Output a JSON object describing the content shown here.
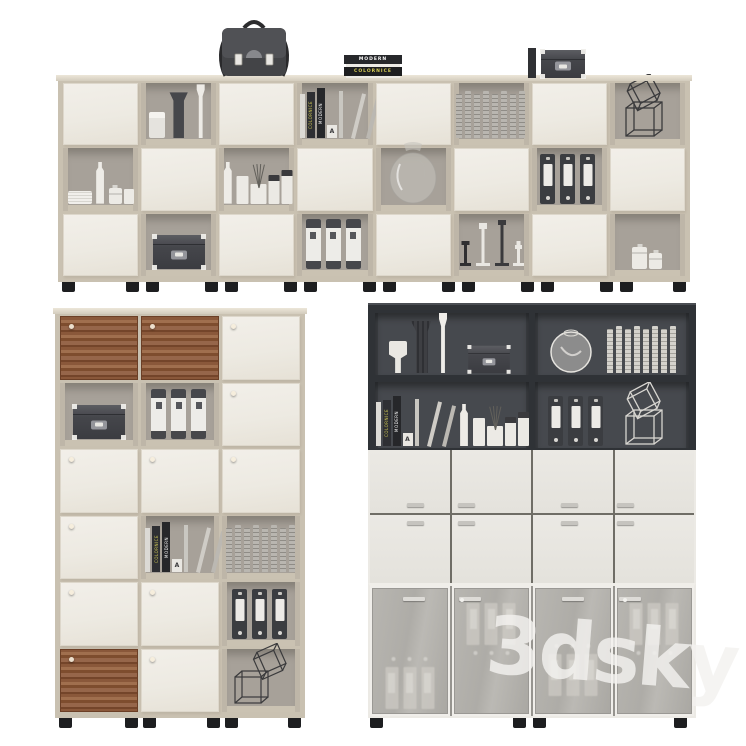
{
  "scene": {
    "description": "3D render of office storage cabinets with decor props",
    "background": "#ffffff",
    "watermark": {
      "text": "3dsky"
    },
    "book_titles": {
      "primary": "MODERN",
      "secondary": "COLORNICE",
      "bookend_letter": "A"
    }
  },
  "palette": {
    "frame_beige": "#c9c1b1",
    "door_cream": "#f0ece5",
    "cell_back": "#a7a199",
    "wood_brown": "#8a583a",
    "dark_cabinet": "#2f3236",
    "dark_back": "#46494e",
    "white_door": "#e9e7e2",
    "glass_gray": "#b2b0ab",
    "foot_black": "#1d1e20",
    "binder_dark": "#3b3d41",
    "item_white": "#eceae5"
  },
  "units": {
    "sideboard": {
      "x": 58,
      "y": 75,
      "w": 632,
      "h": 217,
      "cols": 8,
      "cells": [
        [
          "door",
          "vases3",
          "door",
          "books-lean",
          "door",
          "book-row",
          "door",
          "wire-cube"
        ],
        [
          "white-set",
          "door",
          "diffuser-set",
          "door",
          "glass-vase",
          "door",
          "binders-dark",
          "door"
        ],
        [
          "door",
          "box-dark",
          "door",
          "binders-white",
          "door",
          "candlesticks",
          "door",
          "jars-small"
        ]
      ],
      "top_items": [
        {
          "type": "briefcase",
          "x": 152
        },
        {
          "type": "book-stack",
          "x": 286
        },
        {
          "type": "box-top",
          "x": 470
        }
      ],
      "feet": [
        4,
        68,
        88,
        147,
        167,
        226,
        246,
        305,
        325,
        384,
        404,
        463,
        483,
        542,
        562,
        615
      ]
    },
    "tall_cabinet": {
      "x": 55,
      "y": 308,
      "w": 250,
      "h": 420,
      "cols": 3,
      "cells": [
        [
          "wood",
          "wood",
          "door"
        ],
        [
          "box-dark",
          "binders-white",
          "door"
        ],
        [
          "door",
          "door",
          "door"
        ],
        [
          "door",
          "books-lean",
          "book-row"
        ],
        [
          "door",
          "door",
          "binders-dark"
        ],
        [
          "wood",
          "door",
          "wire-cubes2"
        ]
      ],
      "feet": [
        4,
        70,
        88,
        152,
        170,
        233
      ]
    },
    "office_cabinet": {
      "x": 368,
      "y": 303,
      "w": 328,
      "h": 425,
      "dark_shelves": [
        [
          "vases3d",
          "box-dark-sm"
        ],
        [
          "sphere-vase",
          "book-row-light"
        ],
        [
          "books-lean-d",
          "diffuser-set"
        ],
        [
          "binders-dark",
          "wire-cube-light"
        ]
      ],
      "mid_handles_x": [
        0.58,
        0.2,
        0.47,
        0.15
      ],
      "glass_doors": [
        {
          "handle_x": 0.55,
          "dot": false,
          "ghost_top": 0.42
        },
        {
          "handle_x": 0.22,
          "dot": true,
          "ghost_top": 0.04
        },
        {
          "handle_x": 0.5,
          "dot": false,
          "ghost_top": 0.32
        },
        {
          "handle_x": 0.18,
          "dot": true,
          "ghost_top": 0.04
        }
      ],
      "feet": [
        2,
        145,
        165,
        306
      ]
    }
  }
}
